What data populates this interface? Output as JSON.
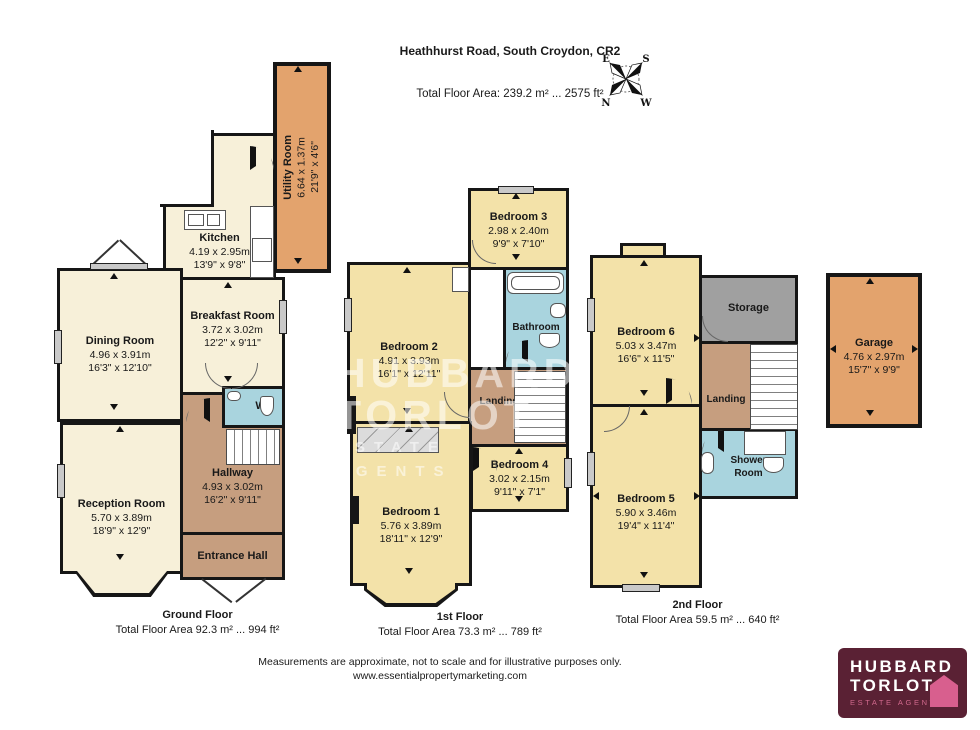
{
  "header": {
    "title": "Heathhurst Road, South Croydon, CR2",
    "total_area": "Total Floor Area: 239.2 m² ... 2575 ft²"
  },
  "compass": {
    "e": "E",
    "s": "S",
    "n": "N",
    "w": "W"
  },
  "ground": {
    "caption": "Ground Floor",
    "area": "Total Floor Area 92.3 m² ... 994 ft²",
    "utility": {
      "name": "Utility Room",
      "m": "6.64 x 1.37m",
      "ft": "21'9\" x 4'6\""
    },
    "kitchen": {
      "name": "Kitchen",
      "m": "4.19 x 2.95m",
      "ft": "13'9\" x 9'8\""
    },
    "breakfast": {
      "name": "Breakfast Room",
      "m": "3.72 x 3.02m",
      "ft": "12'2\" x 9'11\""
    },
    "dining": {
      "name": "Dining Room",
      "m": "4.96 x 3.91m",
      "ft": "16'3\" x 12'10\""
    },
    "wc": {
      "name": "WC"
    },
    "hallway": {
      "name": "Hallway",
      "m": "4.93 x 3.02m",
      "ft": "16'2\" x 9'11\""
    },
    "reception": {
      "name": "Reception Room",
      "m": "5.70 x 3.89m",
      "ft": "18'9\" x 12'9\""
    },
    "entrance": {
      "name": "Entrance Hall"
    }
  },
  "first": {
    "caption": "1st Floor",
    "area": "Total Floor Area 73.3 m² ... 789 ft²",
    "bedroom3": {
      "name": "Bedroom 3",
      "m": "2.98 x 2.40m",
      "ft": "9'9\" x 7'10\""
    },
    "bedroom2": {
      "name": "Bedroom 2",
      "m": "4.91 x 3.93m",
      "ft": "16'1\" x 12'11\""
    },
    "bathroom": {
      "name": "Bathroom"
    },
    "landing": {
      "name": "Landing"
    },
    "bedroom4": {
      "name": "Bedroom 4",
      "m": "3.02 x 2.15m",
      "ft": "9'11\" x 7'1\""
    },
    "bedroom1": {
      "name": "Bedroom 1",
      "m": "5.76 x 3.89m",
      "ft": "18'11\" x 12'9\""
    }
  },
  "second": {
    "caption": "2nd Floor",
    "area": "Total Floor Area 59.5 m² ... 640 ft²",
    "bedroom6": {
      "name": "Bedroom 6",
      "m": "5.03 x 3.47m",
      "ft": "16'6\" x 11'5\""
    },
    "storage": {
      "name": "Storage"
    },
    "landing": {
      "name": "Landing"
    },
    "shower": {
      "name": "Shower Room"
    },
    "bedroom5": {
      "name": "Bedroom 5",
      "m": "5.90 x 3.46m",
      "ft": "19'4\" x 11'4\""
    }
  },
  "garage": {
    "name": "Garage",
    "m": "4.76 x 2.97m",
    "ft": "15'7\" x 9'9\""
  },
  "watermark": {
    "line1": "HUBBARD",
    "line2": "TORLOT",
    "line3": "ESTATE AGENTS"
  },
  "footer": {
    "line1": "Measurements are approximate, not to scale and for illustrative purposes only.",
    "line2": "www.essentialpropertymarketing.com"
  },
  "logo": {
    "line1": "HUBBARD",
    "line2": "TORLOT",
    "tagline": "ESTATE AGENTS"
  },
  "colors": {
    "cream": "#f7f0d9",
    "yellow": "#f3e2a9",
    "orange": "#e3a36d",
    "brown": "#c69e7f",
    "blue": "#a9d4de",
    "storage_gray": "#a0a0a0",
    "wall": "#161616",
    "logo_bg": "#5a2134",
    "logo_pink": "#d85f8e"
  }
}
